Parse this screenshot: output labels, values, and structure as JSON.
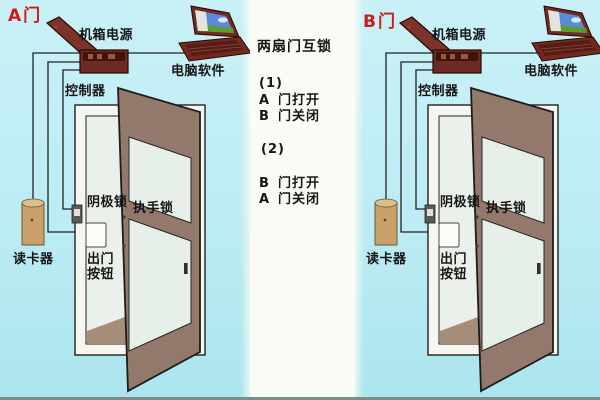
{
  "colors": {
    "sky_top": "#c9f1f7",
    "sky_bottom": "#aae5ee",
    "panel": "#fbfbf5",
    "bottom_bar": "#7d8d87",
    "wire": "#222222",
    "frame": "#f6f6f0",
    "interior": "#eaf1ea",
    "floor": "#a68d7a",
    "door": "#93796b",
    "glass": "#e7efe9",
    "box": "#6d2a22",
    "lid": "#7c332a",
    "laptop": "#73291f",
    "reader": "#c8a06a",
    "label_text": "#161616",
    "door_name_red": "#ce1a1a"
  },
  "legend": {
    "title": "两扇门互锁",
    "case1": {
      "num": "(1)",
      "line1": {
        "key": "A",
        "text": "门打开"
      },
      "line2": {
        "key": "B",
        "text": "门关闭"
      }
    },
    "case2": {
      "num": "(2)",
      "line1": {
        "key": "B",
        "text": "门打开"
      },
      "line2": {
        "key": "A",
        "text": "门关闭"
      }
    }
  },
  "sections": [
    {
      "door_name": "A门",
      "labels": {
        "power": "机箱电源",
        "controller": "控制器",
        "software": "电脑软件",
        "cathode_lock": "阴极锁",
        "handle_lock": "执手锁",
        "exit_line1": "出门",
        "exit_line2": "按钮",
        "card_reader": "读卡器"
      }
    },
    {
      "door_name": "B门",
      "labels": {
        "power": "机箱电源",
        "controller": "控制器",
        "software": "电脑软件",
        "cathode_lock": "阴极锁",
        "handle_lock": "执手锁",
        "exit_line1": "出门",
        "exit_line2": "按钮",
        "card_reader": "读卡器"
      }
    }
  ]
}
